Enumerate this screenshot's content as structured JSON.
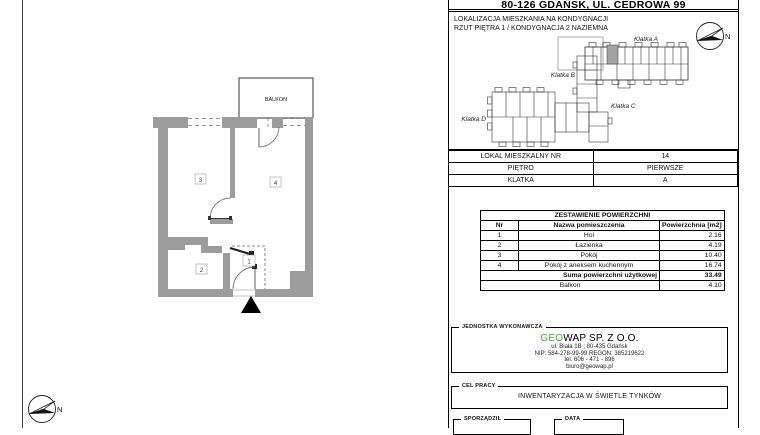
{
  "title": "80-126 GDAŃSK, UL. CEDROWA 99",
  "north_label": "N",
  "location_section": {
    "line1": "LOKALIZACJA MIESZKANIA NA KONDYGNACJI",
    "line2": "RZUT PIĘTRA 1 / KONDYGNACJA 2 NAZIEMNA",
    "labels": {
      "a": "Klatka A",
      "b": "Klatka B",
      "c": "Klatka C",
      "d": "Klatka D"
    }
  },
  "unit_info": {
    "rows": [
      {
        "label": "LOKAL MIESZKALNY NR",
        "value": "14"
      },
      {
        "label": "PIĘTRO",
        "value": "PIERWSZE"
      },
      {
        "label": "KLATKA",
        "value": "A"
      }
    ]
  },
  "area_table": {
    "title": "ZESTAWIENIE POWIERZCHNI",
    "col_nr": "Nr",
    "col_name": "Nazwa pomieszczenia",
    "col_area": "Powierzchnia [m2]",
    "rooms": [
      {
        "nr": "1",
        "name": "Hol",
        "area": "2.16"
      },
      {
        "nr": "2",
        "name": "Łazienka",
        "area": "4.19"
      },
      {
        "nr": "3",
        "name": "Pokój",
        "area": "10.40"
      },
      {
        "nr": "4",
        "name": "Pokój z aneksem kuchennym",
        "area": "16.74"
      }
    ],
    "sum_label": "Suma powierzchni użytkowej",
    "sum_value": "33.49",
    "balcony_label": "Balkon",
    "balcony_value": "4.10"
  },
  "contractor": {
    "section_label": "JEDNOSTKA WYKONAWCZA",
    "name_green": "GEO",
    "name_rest": "WAP SP. Z O.O.",
    "address": "ul. Biała 1B ; 80-435 Gdańsk",
    "nip_regon": "NIP: 584-278-99-99 REGON: 385219622",
    "phone": "tel. 606 - 471 - 896",
    "email": "biuro@geowap.pl"
  },
  "purpose": {
    "section_label": "CEL PRACY",
    "value": "INWENTARYZACJA W ŚWIETLE TYNKÓW"
  },
  "footer": {
    "prepared_label": "SPORZĄDZIŁ",
    "date_label": "DATA"
  },
  "floor_plan": {
    "balcony_label": "BALKON",
    "room_labels": [
      "1",
      "2",
      "3",
      "4"
    ]
  },
  "colors": {
    "wall_gray": "#9c9c9c",
    "unit_highlight": "#a3a3a3",
    "brand_green": "#3db039"
  }
}
